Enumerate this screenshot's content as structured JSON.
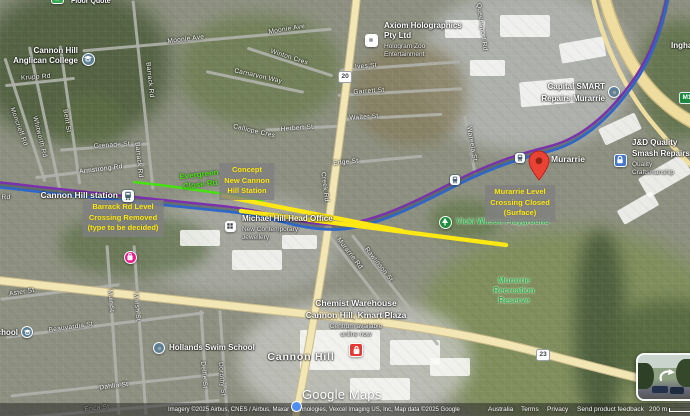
{
  "map_title": "Cannon Hill / Murarrie rail corridor satellite map",
  "colors": {
    "annotation_yellow": "#ffe813",
    "annotation_green": "#46e211",
    "rail_purple": "#7c2fae",
    "rail_blue": "#2e66c9",
    "road_yellow": "#f2e6b4",
    "pin_red": "#ea4335",
    "park_green": "#2fae49"
  },
  "streets": [
    {
      "t": "Moonie Ave",
      "x": 186,
      "y": 40,
      "r": -7
    },
    {
      "t": "Moonie Ave",
      "x": 287,
      "y": 30,
      "r": -9
    },
    {
      "t": "Winton Cres",
      "x": 289,
      "y": 58,
      "r": 18
    },
    {
      "t": "Carnarvon Way",
      "x": 258,
      "y": 77,
      "r": 13
    },
    {
      "t": "Krupp Rd",
      "x": 36,
      "y": 78,
      "r": -4
    },
    {
      "t": "Barrack Rd",
      "x": 149,
      "y": 80,
      "r": 84
    },
    {
      "t": "Barrack Rd",
      "x": 138,
      "y": 160,
      "r": 84
    },
    {
      "t": "Moncrieff Rd",
      "x": 18,
      "y": 127,
      "r": 70
    },
    {
      "t": "Whitworth Rd",
      "x": 39,
      "y": 137,
      "r": 76
    },
    {
      "t": "Bent St",
      "x": 66,
      "y": 121,
      "r": 81
    },
    {
      "t": "Grenade St",
      "x": 112,
      "y": 146,
      "r": -4
    },
    {
      "t": "Armstrong Rd",
      "x": 101,
      "y": 170,
      "r": -7
    },
    {
      "t": "Calliope Cres",
      "x": 254,
      "y": 132,
      "r": 13
    },
    {
      "t": "Ives St",
      "x": 366,
      "y": 67,
      "r": -4
    },
    {
      "t": "Garrett St",
      "x": 369,
      "y": 92,
      "r": -4
    },
    {
      "t": "Walter St",
      "x": 364,
      "y": 118,
      "r": -4
    },
    {
      "t": "Herbert St",
      "x": 297,
      "y": 129,
      "r": -4
    },
    {
      "t": "Edge St",
      "x": 346,
      "y": 163,
      "r": -6
    },
    {
      "t": "Creek Rd",
      "x": 324,
      "y": 187,
      "r": 83
    },
    {
      "t": "Queensport Rd",
      "x": 481,
      "y": 27,
      "r": 82
    },
    {
      "t": "Wareela St",
      "x": 471,
      "y": 144,
      "r": 80
    },
    {
      "t": "Murarrie Rd",
      "x": 349,
      "y": 254,
      "r": 52
    },
    {
      "t": "Rawlinson St",
      "x": 378,
      "y": 265,
      "r": 52
    },
    {
      "t": "Aster St",
      "x": 22,
      "y": 293,
      "r": -9
    },
    {
      "t": "Beauvardia St",
      "x": 71,
      "y": 328,
      "r": -8
    },
    {
      "t": "Muir St",
      "x": 110,
      "y": 301,
      "r": 85
    },
    {
      "t": "Marsh St",
      "x": 136,
      "y": 307,
      "r": 85
    },
    {
      "t": "Dahlia St",
      "x": 114,
      "y": 387,
      "r": -7
    },
    {
      "t": "Erica St",
      "x": 97,
      "y": 409,
      "r": -6
    },
    {
      "t": "Delfie St",
      "x": 203,
      "y": 375,
      "r": 85
    },
    {
      "t": "Dorothy St",
      "x": 221,
      "y": 379,
      "r": 85
    },
    {
      "t": "Rd",
      "x": 6,
      "y": 198,
      "r": 0
    }
  ],
  "pois": [
    {
      "name": "floor-quote-poi",
      "icon": {
        "name": "store-icon",
        "glyph": "bag",
        "x": 57,
        "y": -3,
        "d": 13,
        "bg": "#34a853",
        "shape": "square"
      },
      "lines": [
        {
          "t": "Floor Quote",
          "x": 71,
          "y": -2,
          "cls": "s7"
        }
      ]
    },
    {
      "name": "cannon-hill-anglican-college-poi",
      "icon": {
        "name": "school-icon",
        "glyph": "cap",
        "x": 88,
        "y": 59,
        "d": 13,
        "bg": "#5b7f95",
        "shape": "circle"
      },
      "lines": [
        {
          "t": "Cannon Hill",
          "x": 78,
          "y": 47,
          "cls": "end"
        },
        {
          "t": "Anglican College",
          "x": 78,
          "y": 57,
          "cls": "end"
        }
      ]
    },
    {
      "name": "axiom-holographics-poi",
      "icon": {
        "name": "building-icon",
        "glyph": "dot",
        "x": 371,
        "y": 40,
        "d": 13,
        "bg": "#ffffff",
        "shape": "square"
      },
      "lines": [
        {
          "t": "Axiom Holographics",
          "x": 384,
          "y": 22,
          "cls": ""
        },
        {
          "t": "Pty Ltd",
          "x": 384,
          "y": 32,
          "cls": ""
        },
        {
          "t": "Hologram Zoo",
          "x": 384,
          "y": 44,
          "cls": "sub"
        },
        {
          "t": "Entertainment",
          "x": 384,
          "y": 52,
          "cls": "sub"
        }
      ]
    },
    {
      "name": "capital-smart-repairs-poi",
      "icon": {
        "name": "repair-shop-icon",
        "glyph": "dot",
        "x": 614,
        "y": 92,
        "d": 12,
        "bg": "#5b7f95",
        "shape": "circle"
      },
      "lines": [
        {
          "t": "Capital SMART",
          "x": 605,
          "y": 83,
          "cls": "end"
        },
        {
          "t": "Repairs Murarrie",
          "x": 605,
          "y": 95,
          "cls": "end"
        }
      ]
    },
    {
      "name": "jd-quality-smash-repairs-poi",
      "icon": {
        "name": "lock-icon",
        "glyph": "lock",
        "x": 620,
        "y": 160,
        "d": 13,
        "bg": "#4778c8",
        "shape": "square"
      },
      "lines": [
        {
          "t": "J&D Quality",
          "x": 632,
          "y": 139,
          "cls": ""
        },
        {
          "t": "Smash Repairs",
          "x": 632,
          "y": 150,
          "cls": ""
        },
        {
          "t": "Quality",
          "x": 632,
          "y": 162,
          "cls": "sub"
        },
        {
          "t": "Craftsmanship",
          "x": 632,
          "y": 170,
          "cls": "sub"
        }
      ]
    },
    {
      "name": "michael-hill-head-office-poi",
      "icon": {
        "name": "office-icon",
        "glyph": "grid",
        "x": 230,
        "y": 226,
        "d": 11,
        "bg": "#ffffff",
        "shape": "square"
      },
      "lines": [
        {
          "t": "Michael Hill Head Office",
          "x": 242,
          "y": 215,
          "cls": ""
        },
        {
          "t": "New Contemporary",
          "x": 242,
          "y": 227,
          "cls": "sub"
        },
        {
          "t": "Jewellery",
          "x": 242,
          "y": 235,
          "cls": "sub"
        }
      ]
    },
    {
      "name": "vicki-wilson-playground-poi",
      "icon": {
        "name": "tree-icon",
        "glyph": "tree",
        "x": 445,
        "y": 222,
        "d": 13,
        "bg": "#1e8e3e",
        "shape": "circle"
      },
      "lines": [
        {
          "t": "Vicki Wilson Playground",
          "x": 456,
          "y": 218,
          "cls": "park"
        }
      ]
    },
    {
      "name": "hollands-swim-school-poi",
      "icon": {
        "name": "swim-school-icon",
        "glyph": "dot",
        "x": 159,
        "y": 348,
        "d": 12,
        "bg": "#5b7f95",
        "shape": "circle"
      },
      "lines": [
        {
          "t": "Hollands Swim School",
          "x": 169,
          "y": 344,
          "cls": ""
        }
      ]
    },
    {
      "name": "chemist-warehouse-poi",
      "icon": {
        "name": "pharmacy-icon",
        "glyph": "bag",
        "x": 356,
        "y": 350,
        "d": 14,
        "bg": "#e53935",
        "shape": "square"
      },
      "lines": [
        {
          "t": "Chemist Warehouse",
          "x": 356,
          "y": 299,
          "cls": "center s85"
        },
        {
          "t": "Cannon Hill, Kmart Plaza",
          "x": 356,
          "y": 311,
          "cls": "center s85"
        },
        {
          "t": "Centrum available",
          "x": 356,
          "y": 324,
          "cls": "center sub"
        },
        {
          "t": "online now",
          "x": 356,
          "y": 332,
          "cls": "center sub"
        }
      ]
    },
    {
      "name": "partial-school-poi",
      "icon": {
        "name": "school-icon",
        "glyph": "cap",
        "x": 27,
        "y": 332,
        "d": 12,
        "bg": "#5b7f95",
        "shape": "circle"
      },
      "lines": [
        {
          "t": "School",
          "x": 18,
          "y": 329,
          "cls": "end"
        }
      ]
    },
    {
      "name": "pink-shop-poi",
      "icon": {
        "name": "shopping-icon",
        "glyph": "bag",
        "x": 130,
        "y": 257,
        "d": 13,
        "bg": "#e91e8c",
        "shape": "circle"
      },
      "lines": []
    },
    {
      "name": "inghams-poi",
      "lines": [
        {
          "t": "Inghams",
          "x": 671,
          "y": 42,
          "cls": ""
        }
      ]
    },
    {
      "name": "murarrie-recreation-reserve-label",
      "lines": [
        {
          "t": "Murarrie",
          "x": 514,
          "y": 277,
          "cls": "center park"
        },
        {
          "t": "Recreation",
          "x": 514,
          "y": 287,
          "cls": "center park"
        },
        {
          "t": "Reserve",
          "x": 514,
          "y": 297,
          "cls": "center park"
        }
      ]
    },
    {
      "name": "cannon-hill-suburb-label",
      "lines": [
        {
          "t": "Cannon Hill",
          "x": 301,
          "y": 352,
          "cls": "center suburb"
        }
      ]
    },
    {
      "name": "cannon-hill-station-label",
      "lines": [
        {
          "t": "Cannon Hill station",
          "x": 118,
          "y": 191,
          "cls": "end s85"
        }
      ]
    },
    {
      "name": "murarrie-station-label",
      "lines": [
        {
          "t": "Murarrie",
          "x": 551,
          "y": 155,
          "cls": "s85"
        }
      ]
    }
  ],
  "annotations": [
    {
      "name": "barrack-rd-annotation",
      "cx": 123,
      "top": 200,
      "lines": [
        "Barrack Rd Level",
        "Crossing Removed",
        "(type to be decided)"
      ]
    },
    {
      "name": "concept-station-annotation",
      "cx": 247,
      "top": 163,
      "lines": [
        "Concept",
        "New Cannon",
        "Hill Station"
      ]
    },
    {
      "name": "murarrie-crossing-annotation",
      "cx": 520,
      "top": 185,
      "lines": [
        "Murarrie Level",
        "Crossing Closed",
        "(Surface)"
      ]
    }
  ],
  "green_label": {
    "name": "evergreen-close-annotation",
    "x": 205,
    "y": 180,
    "lines": [
      "Evergreen",
      "Close Rd"
    ]
  },
  "shields": [
    {
      "t": "20",
      "x": 338,
      "y": 71,
      "kind": "white"
    },
    {
      "t": "23",
      "x": 536,
      "y": 349,
      "kind": "white"
    },
    {
      "t": "M1",
      "x": 679,
      "y": 92,
      "kind": "green"
    }
  ],
  "stations": [
    {
      "x": 122,
      "y": 190,
      "s": 12
    },
    {
      "x": 450,
      "y": 175,
      "s": 10
    },
    {
      "x": 515,
      "y": 153,
      "s": 10
    }
  ],
  "pin": {
    "x": 529,
    "y": 151
  },
  "watermark": "Google Maps",
  "footer": {
    "imagery": "Imagery ©2025 Airbus, CNES / Airbus, Maxar Technologies, Vexcel Imaging US, Inc, Map data ©2025 Google",
    "country": "Australia",
    "terms": "Terms",
    "privacy": "Privacy",
    "feedback": "Send product feedback",
    "scale": "200 m"
  }
}
